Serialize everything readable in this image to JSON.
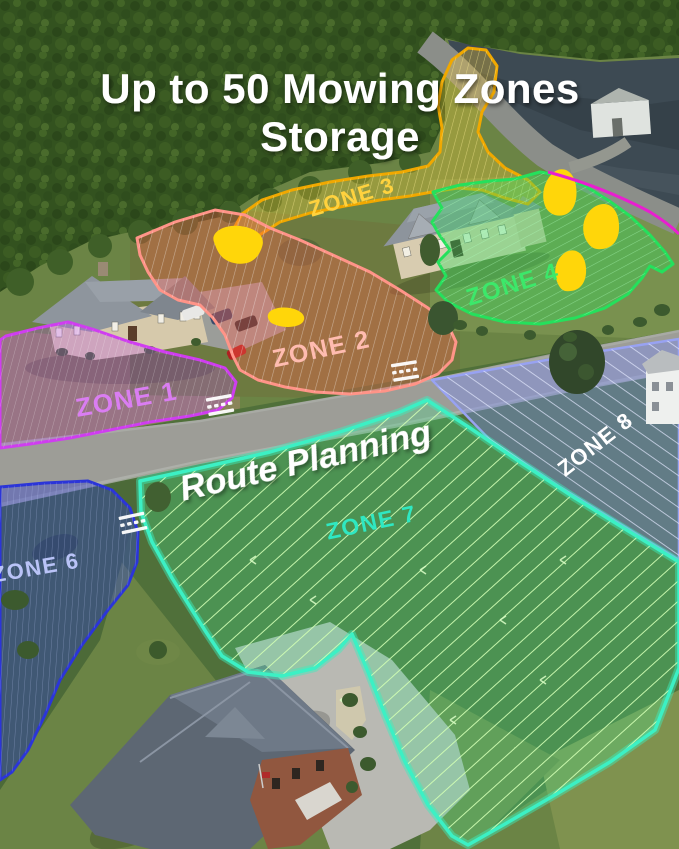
{
  "title": {
    "line1": "Up to 50 Mowing Zones",
    "line2": "Storage"
  },
  "overlay": {
    "route_planning": "Route Planning"
  },
  "zones": [
    {
      "label": "ZONE 1",
      "outline_color": "#cf3df0",
      "label_color": "#da7df2"
    },
    {
      "label": "ZONE 2",
      "outline_color": "#ff9488",
      "label_color": "#ffbcb0"
    },
    {
      "label": "ZONE 3",
      "outline_color": "#f0a800",
      "label_color": "#ffd23e"
    },
    {
      "label": "ZONE 4",
      "outline_color": "#25e05c",
      "label_color": "#3ce86a"
    },
    {
      "label": "ZONE 6",
      "outline_color": "#2b35d8",
      "label_color": "#b9c3f7"
    },
    {
      "label": "ZONE 7",
      "outline_color": "#3cf0c4",
      "label_color": "#2fe8c2"
    },
    {
      "label": "ZONE 8",
      "outline_color": "#98a2f2",
      "label_color": "#ffffff"
    }
  ],
  "markers": {
    "obstacle_color": "#ffd60a",
    "crossing_marker_color": "#ffffff",
    "partial_zone_outline_color": "#e81fd0"
  },
  "scene_colors": {
    "grass": "#6b8445",
    "forest": "#33521f",
    "water": "#3d4a53",
    "road": "#9d9d97"
  }
}
